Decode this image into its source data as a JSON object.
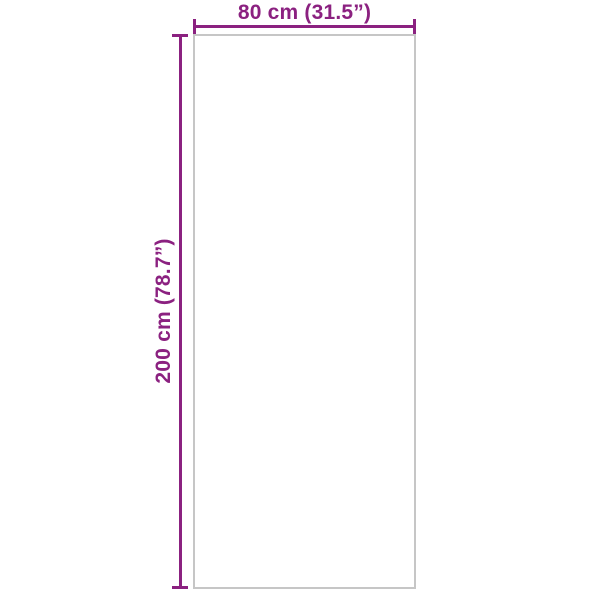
{
  "diagram": {
    "type": "product-dimension-diagram",
    "width_label": "80 cm (31.5”)",
    "height_label": "200 cm (78.7”)",
    "width_cm": 80,
    "width_inches": 31.5,
    "height_cm": 200,
    "height_inches": 78.7
  },
  "colors": {
    "dimension": "#8b2180",
    "outline": "#c6c6c6",
    "background": "#ffffff"
  }
}
